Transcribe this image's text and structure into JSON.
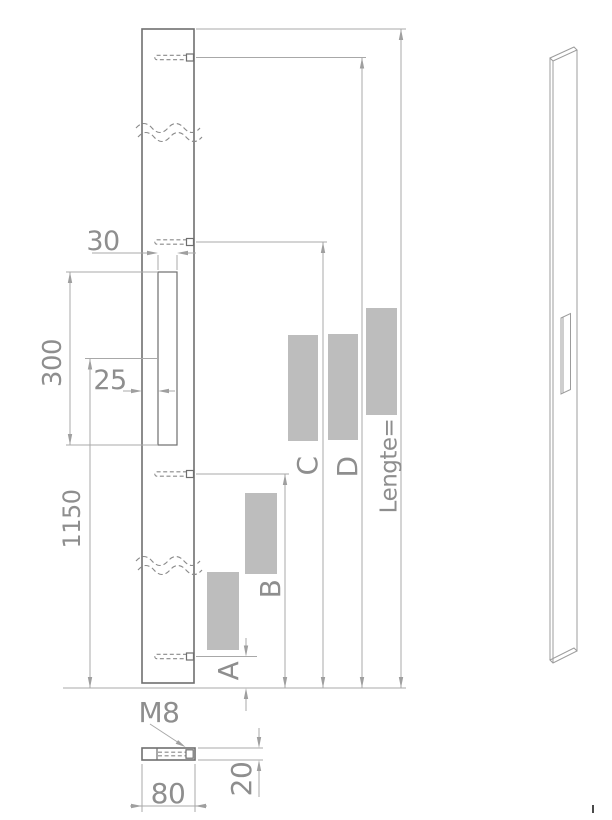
{
  "drawing": {
    "title": "profile-rail-technical-drawing",
    "labels": {
      "slot_width": "30",
      "slot_offset": "25",
      "slot_length": "300",
      "shown_length": "1150",
      "dim_a": "A",
      "dim_b": "B",
      "dim_c": "C",
      "dim_d": "D",
      "total_length": "Lengte=",
      "thread": "M8",
      "profile_width": "80",
      "profile_thickness": "20"
    },
    "colors": {
      "outline": "#6f6f6f",
      "dimension_lines": "#a8a8a8",
      "dimension_text": "#8e8e8e",
      "redaction_box": "#bdbdbd",
      "background": "#ffffff"
    }
  }
}
